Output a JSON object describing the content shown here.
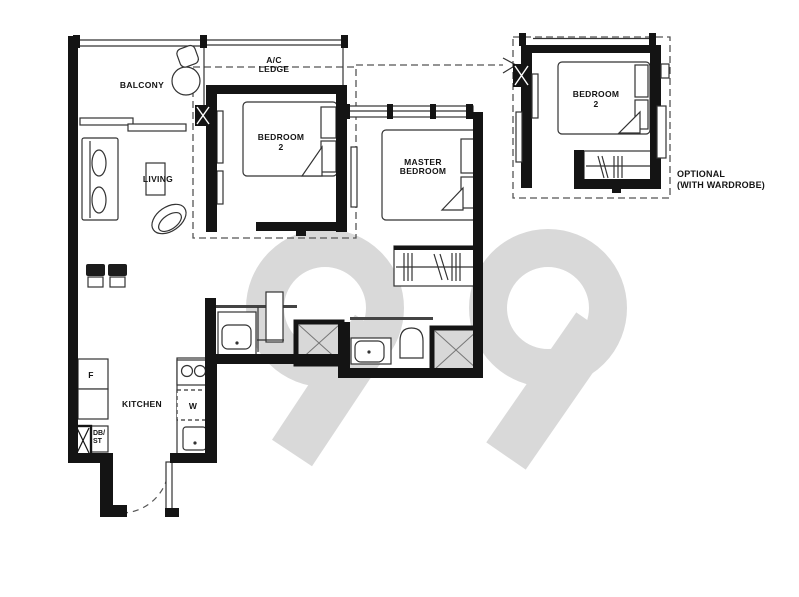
{
  "watermark": "99",
  "rooms": {
    "balcony": "BALCONY",
    "ac_ledge_1": "A/C",
    "ac_ledge_2": "LEDGE",
    "living": "LIVING",
    "bedroom2_1": "BEDROOM",
    "bedroom2_2": "2",
    "master_1": "MASTER",
    "master_2": "BEDROOM",
    "kitchen": "KITCHEN"
  },
  "fixtures": {
    "fridge": "F",
    "washer": "W",
    "db_store_1": "DB/",
    "db_store_2": "ST"
  },
  "optional": {
    "bedroom2_1": "BEDROOM",
    "bedroom2_2": "2",
    "note_1": "OPTIONAL",
    "note_2": "(WITH WARDROBE)"
  },
  "colors": {
    "wall": "#141414",
    "thin_line": "#333333",
    "watermark": "#d9d9d9",
    "shower_fill": "#d8d8d8",
    "background": "#ffffff"
  }
}
